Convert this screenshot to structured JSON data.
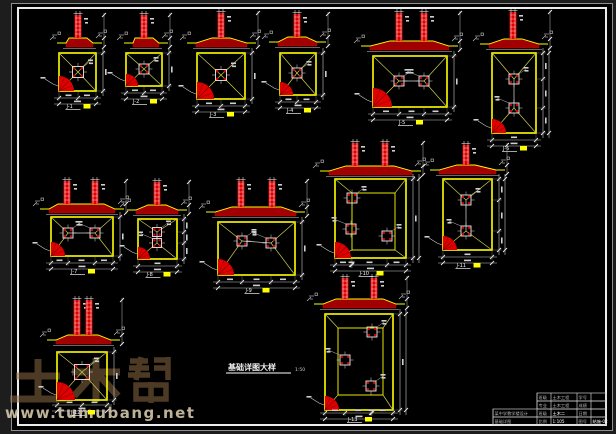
{
  "window": {
    "width": 616,
    "height": 434
  },
  "colors": {
    "bg_outside": "#1d1d1d",
    "bg_sheet": "#000000",
    "frame_outer": "#8f8f8f",
    "frame_inner": "#ececec",
    "yellow": "#ffff00",
    "red": "#e00000",
    "dark_red": "#a00000",
    "hatch_shadow": "#7c0000",
    "line": "#cfcfcf",
    "dim_line": "#c9c9c9",
    "text": "#f2f2f2",
    "watermark_char": "#8a6a42",
    "watermark_url": "#cfc2a6"
  },
  "frame": {
    "outer": [
      11.5,
      3.5,
      601,
      427
    ],
    "inner": [
      18,
      8,
      588,
      417
    ]
  },
  "caption": {
    "text": "基础详图大样",
    "scale": "1:50",
    "x": 228,
    "y": 370
  },
  "watermark": {
    "brand": "土木帮",
    "url": "www.tumubang.net"
  },
  "title_block": {
    "x": 493,
    "y": 393,
    "right": 606,
    "bottom": 425,
    "rows": [
      {
        "y": 393,
        "x0": 537,
        "cells": [
          [
            537,
            551,
            "班级",
            0
          ],
          [
            551,
            577,
            "土木工程",
            0
          ],
          [
            577,
            591,
            "学号",
            0
          ],
          [
            591,
            606,
            "",
            0
          ]
        ]
      },
      {
        "y": 401,
        "x0": 537,
        "cells": [
          [
            537,
            551,
            "专业",
            0
          ],
          [
            551,
            577,
            "土木工程",
            0
          ],
          [
            577,
            591,
            "成绩",
            0
          ],
          [
            591,
            606,
            "",
            0
          ]
        ]
      },
      {
        "y": 409,
        "x0": 493,
        "cells": [
          [
            493,
            537,
            "某中学教学楼设计",
            0
          ],
          [
            537,
            551,
            "班级",
            0
          ],
          [
            551,
            577,
            "土木二",
            1
          ],
          [
            577,
            591,
            "日期",
            0
          ],
          [
            591,
            606,
            "",
            0
          ]
        ]
      },
      {
        "y": 417,
        "x0": 493,
        "cells": [
          [
            493,
            537,
            "基础详图",
            0
          ],
          [
            537,
            551,
            "比例",
            0
          ],
          [
            551,
            577,
            "1:105",
            1
          ],
          [
            577,
            591,
            "图号",
            0
          ],
          [
            591,
            606,
            "结施-02",
            1
          ]
        ]
      }
    ]
  },
  "details": [
    {
      "id": "J-1",
      "plan": [
        59,
        53,
        37,
        38
      ],
      "cols": [
        [
          78,
          72
        ]
      ],
      "size": 11,
      "sec": {
        "fx": [
          66,
          93
        ],
        "base": 43,
        "top": 15,
        "cols": [
          78
        ]
      },
      "qr": 15
    },
    {
      "id": "J-2",
      "plan": [
        126,
        53,
        36,
        33
      ],
      "cols": [
        [
          144,
          69
        ]
      ],
      "size": 10,
      "sec": {
        "fx": [
          133,
          159
        ],
        "base": 43,
        "top": 15,
        "cols": [
          144
        ]
      },
      "qr": 12
    },
    {
      "id": "J-3",
      "plan": [
        197,
        53,
        48,
        46
      ],
      "cols": [
        [
          221,
          75
        ]
      ],
      "size": 11,
      "sec": {
        "fx": [
          196,
          247
        ],
        "base": 43,
        "top": 13,
        "cols": [
          221
        ]
      },
      "qr": 17
    },
    {
      "id": "J-4",
      "plan": [
        280,
        53,
        36,
        42
      ],
      "cols": [
        [
          297,
          73
        ]
      ],
      "size": 10,
      "sec": {
        "fx": [
          278,
          317
        ],
        "base": 42,
        "top": 14,
        "cols": [
          297
        ]
      },
      "qr": 13
    },
    {
      "id": "J-5",
      "plan": [
        373,
        56,
        74,
        51
      ],
      "cols": [
        [
          399,
          81
        ],
        [
          424,
          81
        ]
      ],
      "link": "h",
      "size": 10,
      "sec": {
        "fx": [
          370,
          449
        ],
        "base": 46,
        "top": 13,
        "cols": [
          399,
          424
        ]
      },
      "qr": 19
    },
    {
      "id": "J-6",
      "plan": [
        492,
        53,
        44,
        80
      ],
      "cols": [
        [
          514,
          79
        ],
        [
          514,
          108
        ]
      ],
      "link": "v",
      "size": 10,
      "sec": {
        "fx": [
          489,
          539
        ],
        "base": 44,
        "top": 12,
        "cols": [
          513
        ]
      },
      "qr": 14
    },
    {
      "id": "J-7",
      "plan": [
        51,
        217,
        62,
        39
      ],
      "cols": [
        [
          68,
          233
        ],
        [
          95,
          233
        ]
      ],
      "link": "h",
      "size": 10,
      "sec": {
        "fx": [
          49,
          115
        ],
        "base": 209,
        "top": 181,
        "cols": [
          67,
          95
        ]
      },
      "qr": 14
    },
    {
      "id": "J-8",
      "plan": [
        138,
        219,
        39,
        40
      ],
      "cols": [
        [
          157,
          232
        ],
        [
          157,
          243
        ]
      ],
      "link": "v",
      "size": 9,
      "sec": {
        "fx": [
          136,
          178
        ],
        "base": 210,
        "top": 182,
        "cols": [
          157
        ]
      },
      "qr": 12
    },
    {
      "id": "J-9",
      "plan": [
        218,
        222,
        77,
        53
      ],
      "cols": [
        [
          242,
          241
        ],
        [
          271,
          243
        ]
      ],
      "link": "h",
      "size": 10,
      "sec": {
        "fx": [
          215,
          296
        ],
        "base": 212,
        "top": 181,
        "cols": [
          241,
          272
        ]
      },
      "qr": 16
    },
    {
      "id": "J-10",
      "plan": [
        335,
        179,
        71,
        79
      ],
      "inner": [
        352,
        193,
        43,
        57
      ],
      "cols": [
        [
          352,
          198
        ],
        [
          351,
          229
        ],
        [
          387,
          236
        ]
      ],
      "size": 10,
      "sec": {
        "fx": [
          329,
          412
        ],
        "base": 171,
        "top": 143,
        "cols": [
          355,
          385
        ]
      },
      "qr": 16
    },
    {
      "id": "J-11",
      "plan": [
        443,
        179,
        49,
        71
      ],
      "cols": [
        [
          466,
          200
        ],
        [
          466,
          231
        ]
      ],
      "link": "v",
      "size": 10,
      "sec": {
        "fx": [
          439,
          496
        ],
        "base": 170,
        "top": 145,
        "cols": [
          466
        ]
      },
      "qr": 14
    },
    {
      "id": "J-12",
      "plan": [
        57,
        352,
        50,
        48
      ],
      "cols": [
        [
          82,
          372
        ]
      ],
      "size": 15,
      "sec": {
        "fx": [
          56,
          111
        ],
        "base": 340,
        "top": 300,
        "cols": [
          77,
          89
        ]
      },
      "qr": 18,
      "dimB": 405,
      "labelY": 414
    },
    {
      "id": "J-13",
      "plan": [
        325,
        314,
        68,
        96
      ],
      "inner": [
        338,
        328,
        45,
        67
      ],
      "cols": [
        [
          372,
          332
        ],
        [
          345,
          360
        ],
        [
          371,
          386
        ]
      ],
      "size": 10,
      "sec": {
        "fx": [
          323,
          396
        ],
        "base": 304,
        "top": 278,
        "cols": [
          345,
          374
        ]
      },
      "qr": 14,
      "dimB": 413,
      "labelY": 421
    }
  ]
}
